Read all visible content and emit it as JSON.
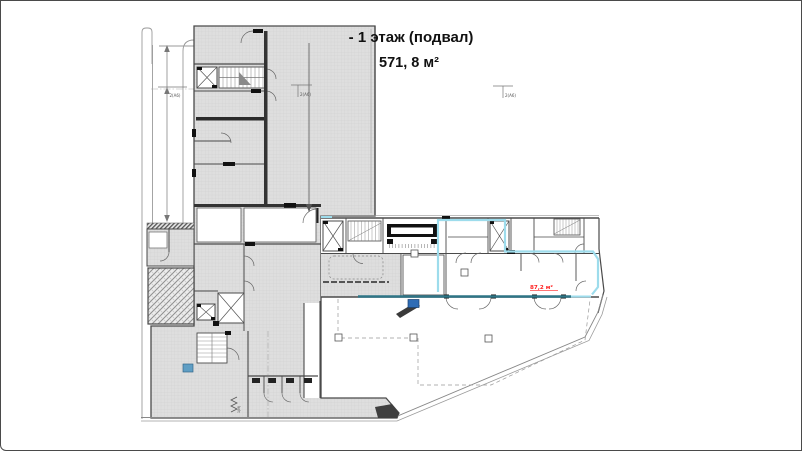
{
  "header": {
    "title": "- 1 этаж (подвал)",
    "area": "571, 8 м²"
  },
  "plan": {
    "area_label": "87,2 м²",
    "axis_label_left": "2(А6)",
    "axis_label_mid": "2(А6)",
    "axis_label_right": "2(А6)",
    "door_label": "1(М)",
    "colors": {
      "red": "#ff2020",
      "highlight": "#9ddcec",
      "highlight_dark": "#2e7586",
      "blue_marker": "#2e6cb5",
      "teal_marker": "#5f9ec4",
      "wall": "#4a4a4a",
      "floor": "#dedede"
    }
  }
}
